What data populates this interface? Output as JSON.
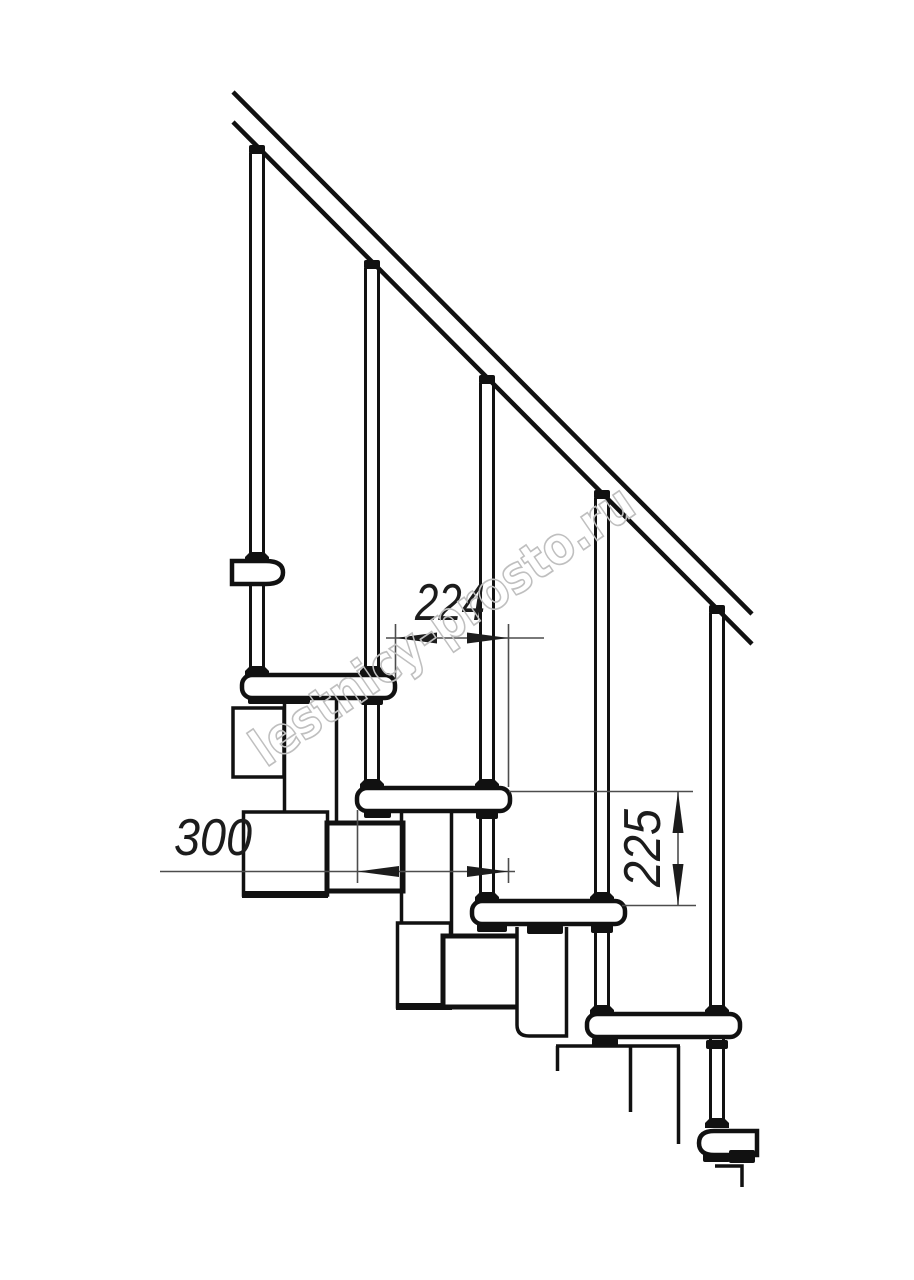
{
  "drawing": {
    "watermark_text": "lestnicy-prosto.ru",
    "dim_run": "224",
    "dim_depth": "300",
    "dim_rise": "225",
    "colors": {
      "line": "#111111",
      "dim_line": "#4d4d4d",
      "dim_text": "#1c1c1c",
      "watermark": "#bfbfbf",
      "background": "#ffffff"
    }
  }
}
